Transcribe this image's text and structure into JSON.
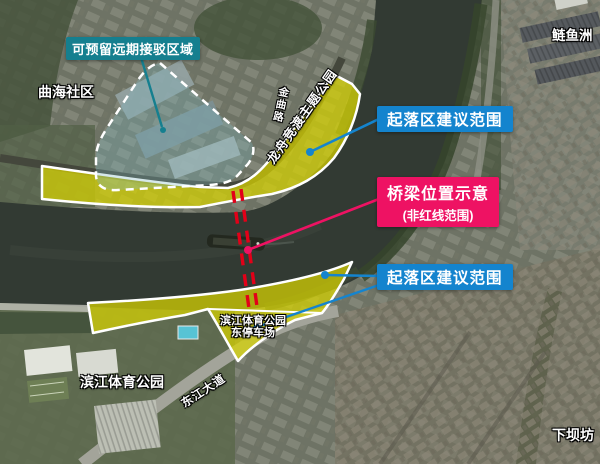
{
  "labels": {
    "reserve_area": "可预留远期接驳区域",
    "quhai_community": "曲海社区",
    "lianyuzhou": "鲢鱼洲",
    "landing_zone_north": "起落区建议范围",
    "bridge_title": "桥梁位置示意",
    "bridge_subtitle": "(非红线范围)",
    "landing_zone_south": "起落区建议范围",
    "parking_line1": "滨江体育公园",
    "parking_line2": "东停车场",
    "sports_park": "滨江体育公园",
    "xiabafang": "下坝坊",
    "dongjiang_avenue": "东江大道",
    "jinqu_road": "金曲路",
    "longzhou_park": "龙舟竞渡主题公园"
  },
  "colors": {
    "reserve_tag_bg": "#157F8F",
    "landing_tag_bg": "#1484CE",
    "bridge_tag_bg": "#EE1263",
    "zone_fill": "#D8D400",
    "bridge_line_red": "#E30018"
  }
}
